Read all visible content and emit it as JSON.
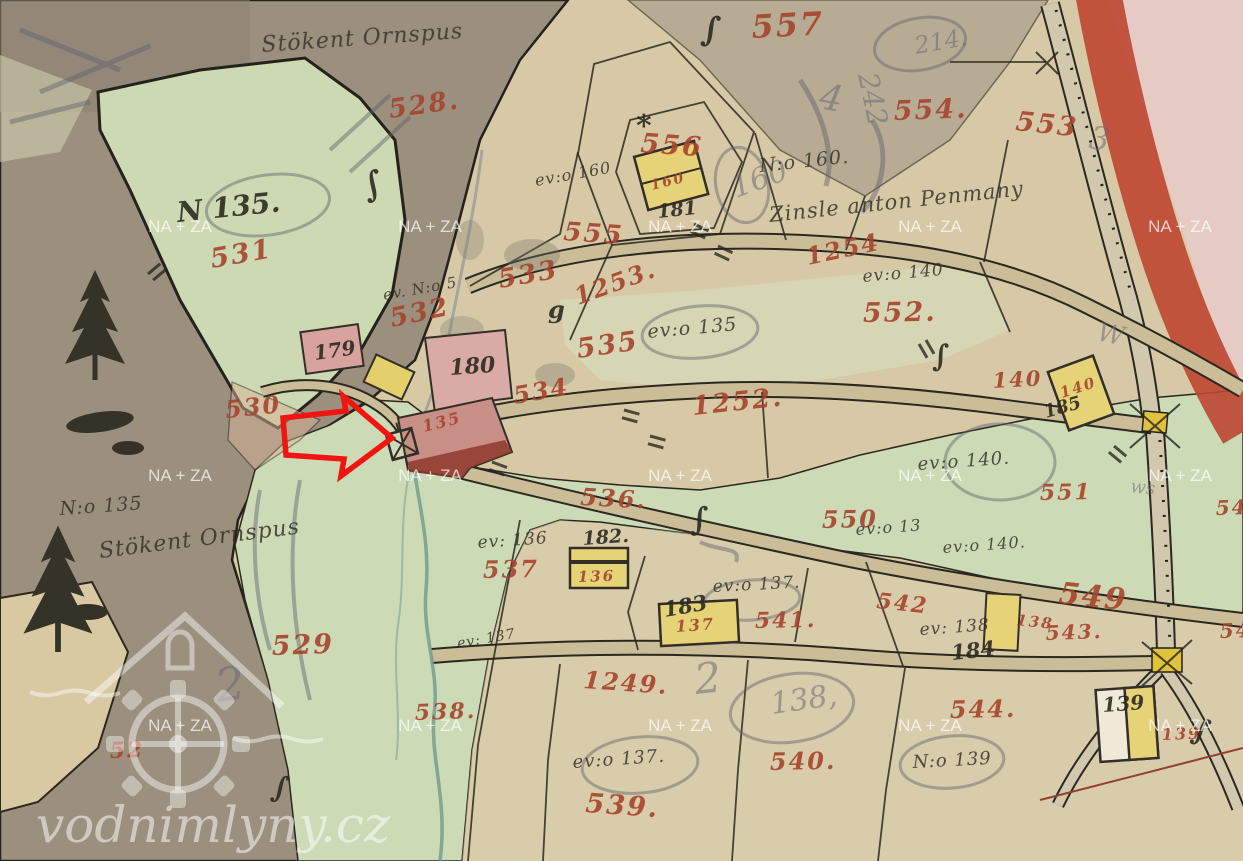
{
  "site_watermark": {
    "name": "vodnimlyny.cz"
  },
  "archive_watermark": {
    "text": "NA + ZA",
    "positions": [
      [
        180,
        232
      ],
      [
        430,
        232
      ],
      [
        680,
        232
      ],
      [
        930,
        232
      ],
      [
        1180,
        232
      ],
      [
        180,
        481
      ],
      [
        430,
        481
      ],
      [
        680,
        481
      ],
      [
        930,
        481
      ],
      [
        1180,
        481
      ],
      [
        180,
        731
      ],
      [
        430,
        731
      ],
      [
        680,
        731
      ],
      [
        930,
        731
      ],
      [
        1180,
        731
      ]
    ]
  },
  "colors": {
    "parcel_red": "#a7432d",
    "ink_black": "#2c2a21",
    "road_red": "#bf4632",
    "building_pink": "#d8a6a0",
    "building_yellow": "#e6d277",
    "meadow_green": "#ccdab6",
    "hill_brown": "#9b8f7e"
  },
  "labels": {
    "red_parcels": [
      {
        "t": "557",
        "x": 752,
        "y": 38,
        "s": 32,
        "r": -3
      },
      {
        "t": "528.",
        "x": 390,
        "y": 118,
        "s": 26,
        "r": -8
      },
      {
        "t": "556",
        "x": 640,
        "y": 152,
        "s": 27,
        "r": 4
      },
      {
        "t": "554.",
        "x": 894,
        "y": 120,
        "s": 27,
        "r": -2
      },
      {
        "t": "553",
        "x": 1015,
        "y": 130,
        "s": 27,
        "r": 6
      },
      {
        "t": "555",
        "x": 563,
        "y": 240,
        "s": 26,
        "r": 4
      },
      {
        "t": "531",
        "x": 212,
        "y": 268,
        "s": 27,
        "r": -10
      },
      {
        "t": "530",
        "x": 226,
        "y": 418,
        "s": 24,
        "r": -6,
        "op": 0.7
      },
      {
        "t": "532",
        "x": 392,
        "y": 327,
        "s": 26,
        "r": -12
      },
      {
        "t": "533",
        "x": 500,
        "y": 288,
        "s": 26,
        "r": -10
      },
      {
        "t": "1253.",
        "x": 578,
        "y": 305,
        "s": 24,
        "r": -20
      },
      {
        "t": "535",
        "x": 578,
        "y": 358,
        "s": 27,
        "r": -8
      },
      {
        "t": "534",
        "x": 515,
        "y": 404,
        "s": 24,
        "r": -10
      },
      {
        "t": "1254",
        "x": 808,
        "y": 265,
        "s": 24,
        "r": -12
      },
      {
        "t": "552.",
        "x": 863,
        "y": 322,
        "s": 27,
        "r": -1
      },
      {
        "t": "1252.",
        "x": 693,
        "y": 415,
        "s": 26,
        "r": -6
      },
      {
        "t": "140",
        "x": 993,
        "y": 388,
        "s": 21,
        "r": -3
      },
      {
        "t": "140",
        "x": 1062,
        "y": 398,
        "s": 15,
        "r": -18
      },
      {
        "t": "551",
        "x": 1040,
        "y": 500,
        "s": 22,
        "r": -1
      },
      {
        "t": "550",
        "x": 822,
        "y": 528,
        "s": 24,
        "r": -1
      },
      {
        "t": "536.",
        "x": 580,
        "y": 505,
        "s": 24,
        "r": 3
      },
      {
        "t": "160",
        "x": 652,
        "y": 190,
        "s": 14,
        "r": -14
      },
      {
        "t": "135",
        "x": 424,
        "y": 432,
        "s": 16,
        "r": -14
      },
      {
        "t": "136",
        "x": 578,
        "y": 582,
        "s": 15,
        "r": -2
      },
      {
        "t": "537",
        "x": 483,
        "y": 578,
        "s": 24,
        "r": -1
      },
      {
        "t": "541.",
        "x": 755,
        "y": 628,
        "s": 22,
        "r": -1
      },
      {
        "t": "137",
        "x": 676,
        "y": 632,
        "s": 16,
        "r": -4
      },
      {
        "t": "542",
        "x": 876,
        "y": 608,
        "s": 22,
        "r": 6
      },
      {
        "t": "138",
        "x": 1016,
        "y": 625,
        "s": 15,
        "r": 6
      },
      {
        "t": "543.",
        "x": 1046,
        "y": 640,
        "s": 20,
        "r": -2
      },
      {
        "t": "549",
        "x": 1058,
        "y": 603,
        "s": 30,
        "r": 6
      },
      {
        "t": "1249.",
        "x": 583,
        "y": 688,
        "s": 24,
        "r": 4
      },
      {
        "t": "538.",
        "x": 415,
        "y": 720,
        "s": 22,
        "r": -2
      },
      {
        "t": "539.",
        "x": 585,
        "y": 812,
        "s": 27,
        "r": 4
      },
      {
        "t": "540.",
        "x": 770,
        "y": 770,
        "s": 24,
        "r": -1
      },
      {
        "t": "544.",
        "x": 950,
        "y": 718,
        "s": 24,
        "r": -1
      },
      {
        "t": "529",
        "x": 272,
        "y": 655,
        "s": 27,
        "r": -2
      },
      {
        "t": "139",
        "x": 1162,
        "y": 740,
        "s": 16,
        "r": -2,
        "op": 0.55
      },
      {
        "t": "52",
        "x": 110,
        "y": 758,
        "s": 22,
        "r": -2,
        "op": 0.6
      },
      {
        "t": "54",
        "x": 1216,
        "y": 515,
        "s": 20,
        "r": -2
      },
      {
        "t": "54",
        "x": 1220,
        "y": 638,
        "s": 20,
        "r": -2
      }
    ],
    "black": [
      {
        "t": "N 135.",
        "x": 178,
        "y": 222,
        "s": 28,
        "r": -6
      },
      {
        "t": "181",
        "x": 658,
        "y": 218,
        "s": 19,
        "r": -6
      },
      {
        "t": "182.",
        "x": 583,
        "y": 545,
        "s": 19,
        "r": -4
      },
      {
        "t": "183",
        "x": 665,
        "y": 617,
        "s": 21,
        "r": -10
      },
      {
        "t": "184",
        "x": 952,
        "y": 660,
        "s": 21,
        "r": -6
      },
      {
        "t": "185",
        "x": 1046,
        "y": 418,
        "s": 18,
        "r": -16
      },
      {
        "t": "139",
        "x": 1103,
        "y": 712,
        "s": 20,
        "r": -4
      },
      {
        "t": "179",
        "x": 315,
        "y": 360,
        "s": 20,
        "r": -8
      },
      {
        "t": "180",
        "x": 450,
        "y": 375,
        "s": 22,
        "r": -4
      },
      {
        "t": "g",
        "x": 548,
        "y": 318,
        "s": 24,
        "r": 0
      },
      {
        "t": "*",
        "x": 636,
        "y": 136,
        "s": 30,
        "r": 0
      },
      {
        "t": "∫",
        "x": 366,
        "y": 198,
        "s": 34,
        "r": -15
      },
      {
        "t": "∫",
        "x": 700,
        "y": 40,
        "s": 34,
        "r": 5
      },
      {
        "t": "∫",
        "x": 690,
        "y": 530,
        "s": 32,
        "r": 0
      },
      {
        "t": "∫",
        "x": 932,
        "y": 366,
        "s": 30,
        "r": 0
      },
      {
        "t": "∫",
        "x": 270,
        "y": 796,
        "s": 30,
        "r": 10
      },
      {
        "t": "∫",
        "x": 1190,
        "y": 738,
        "s": 30,
        "r": 15
      }
    ],
    "annotations": [
      {
        "t": "Stökent Ornspus",
        "x": 262,
        "y": 52,
        "s": 22,
        "r": -4
      },
      {
        "t": "Stökent Ornspus",
        "x": 100,
        "y": 558,
        "s": 22,
        "r": -7
      },
      {
        "t": "N:o 135",
        "x": 60,
        "y": 515,
        "s": 19,
        "r": -4
      },
      {
        "t": "Zinsle anton Penmany",
        "x": 770,
        "y": 222,
        "s": 21,
        "r": -6
      },
      {
        "t": "N:o 160.",
        "x": 760,
        "y": 172,
        "s": 19,
        "r": -6
      },
      {
        "t": "ev:o 160",
        "x": 536,
        "y": 186,
        "s": 16,
        "r": -10
      },
      {
        "t": "ev. N:o 5",
        "x": 384,
        "y": 300,
        "s": 15,
        "r": -10
      },
      {
        "t": "ev:o 135",
        "x": 648,
        "y": 338,
        "s": 19,
        "r": -5
      },
      {
        "t": "ev:o 140",
        "x": 863,
        "y": 282,
        "s": 17,
        "r": -5
      },
      {
        "t": "ev:o 140.",
        "x": 918,
        "y": 470,
        "s": 18,
        "r": -4
      },
      {
        "t": "ev:o 13",
        "x": 856,
        "y": 535,
        "s": 16,
        "r": -4
      },
      {
        "t": "ev:o 140.",
        "x": 943,
        "y": 553,
        "s": 16,
        "r": -4
      },
      {
        "t": "ev: 136",
        "x": 478,
        "y": 548,
        "s": 17,
        "r": -4
      },
      {
        "t": "ev:o 137.",
        "x": 713,
        "y": 592,
        "s": 17,
        "r": -3
      },
      {
        "t": "ev: 138",
        "x": 920,
        "y": 635,
        "s": 17,
        "r": -4
      },
      {
        "t": "ev: 137",
        "x": 458,
        "y": 648,
        "s": 14,
        "r": -10
      },
      {
        "t": "ev:o 137.",
        "x": 573,
        "y": 768,
        "s": 18,
        "r": -4
      },
      {
        "t": "N:o 139",
        "x": 913,
        "y": 768,
        "s": 18,
        "r": -3
      }
    ],
    "pencil": [
      {
        "t": "214.",
        "x": 916,
        "y": 54,
        "s": 24,
        "r": -10
      },
      {
        "t": "160",
        "x": 736,
        "y": 198,
        "s": 30,
        "r": -20
      },
      {
        "t": "W",
        "x": 1096,
        "y": 340,
        "s": 26,
        "r": 12
      },
      {
        "t": "242",
        "x": 858,
        "y": 75,
        "s": 28,
        "r": 78
      },
      {
        "t": "2",
        "x": 218,
        "y": 702,
        "s": 46,
        "r": -8
      },
      {
        "t": "2",
        "x": 696,
        "y": 694,
        "s": 42,
        "r": -6
      },
      {
        "t": "138,",
        "x": 772,
        "y": 714,
        "s": 30,
        "r": -8
      },
      {
        "t": "4",
        "x": 818,
        "y": 108,
        "s": 36,
        "r": 10
      },
      {
        "t": "3",
        "x": 1088,
        "y": 148,
        "s": 32,
        "r": 8
      },
      {
        "t": "ws",
        "x": 1130,
        "y": 492,
        "s": 18,
        "r": 6
      }
    ]
  }
}
